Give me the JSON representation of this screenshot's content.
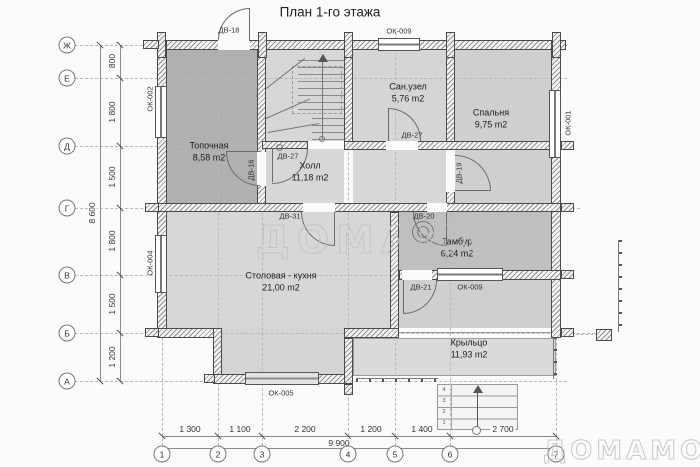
{
  "title": "План 1-го этажа",
  "watermark": "ДОМАМО",
  "axes": {
    "rows": [
      "Ж",
      "Е",
      "Д",
      "Г",
      "В",
      "Б",
      "А"
    ],
    "cols": [
      "1",
      "2",
      "3",
      "4",
      "5",
      "6",
      "7"
    ]
  },
  "dimensions": {
    "left_total": "8 600",
    "left_segments": [
      "800",
      "1 800",
      "1 500",
      "1 800",
      "1 500",
      "1 200"
    ],
    "bottom_total": "9 900",
    "bottom_segments": [
      "1 300",
      "1 100",
      "2 200",
      "1 200",
      "1 400",
      "2 700"
    ]
  },
  "rooms": {
    "topochnaya": {
      "name": "Топочная",
      "area": "8,58 m2"
    },
    "hall": {
      "name": "Холл",
      "area": "11,18 m2"
    },
    "sanuzel": {
      "name": "Сан.узел",
      "area": "5,76 m2"
    },
    "spalnya": {
      "name": "Спальня",
      "area": "9,75 m2"
    },
    "stolovaya": {
      "name": "Столовая - кухня",
      "area": "21,00 m2"
    },
    "tambur": {
      "name": "Тамбур",
      "area": "6,24 m2"
    },
    "krylco": {
      "name": "Крыльцо",
      "area": "11,93 m2"
    }
  },
  "doors": {
    "dv18": "ДВ-18",
    "dv16": "ДВ-16",
    "dv27_stairs": "ДВ-27",
    "dv27_san": "ДВ-27",
    "dv31": "ДВ-31",
    "dv19": "ДВ-19",
    "dv20": "ДВ-20",
    "dv21": "ДВ-21"
  },
  "windows": {
    "ok002": "ОК-002",
    "ok009_top": "ОК-009",
    "ok001": "ОК-001",
    "ok004": "ОК-004",
    "ok005": "ОК-005",
    "ok009_tambur": "ОК-009"
  },
  "entry_steps": [
    "4",
    "3",
    "2",
    "1"
  ],
  "colors": {
    "room_dark": "#b0b0b0",
    "room_light": "#d6d6d6",
    "room_medium": "#bfbfbf",
    "wall_line": "#4a4a4a",
    "watermark": "#c3c3c3"
  }
}
